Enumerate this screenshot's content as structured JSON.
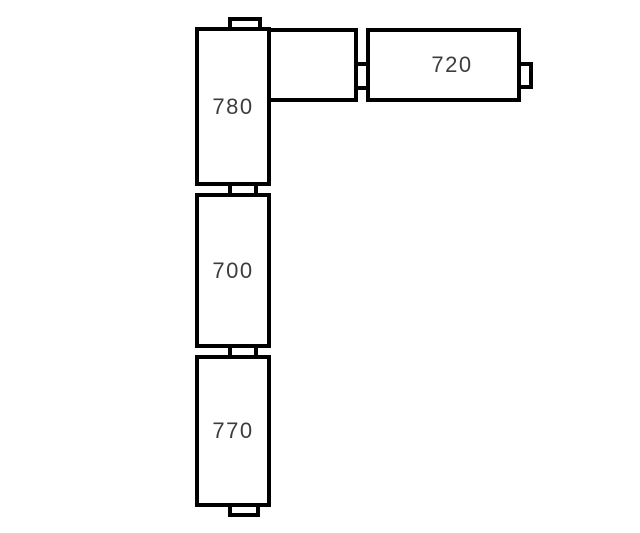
{
  "diagram": {
    "background_color": "#ffffff",
    "stroke_color": "#000000",
    "label_color": "#3d3d3d",
    "modules": [
      {
        "name": "module-780",
        "label": "780"
      },
      {
        "name": "module-blank",
        "label": ""
      },
      {
        "name": "module-720",
        "label": "720"
      },
      {
        "name": "module-700",
        "label": "700"
      },
      {
        "name": "module-770",
        "label": "770"
      }
    ],
    "connectors": [
      {
        "name": "connector-tab-top"
      },
      {
        "name": "connector-tab-780-700"
      },
      {
        "name": "connector-tab-700-770"
      },
      {
        "name": "connector-tab-bottom"
      },
      {
        "name": "connector-tab-blank-720"
      },
      {
        "name": "connector-tab-720-right"
      }
    ]
  }
}
